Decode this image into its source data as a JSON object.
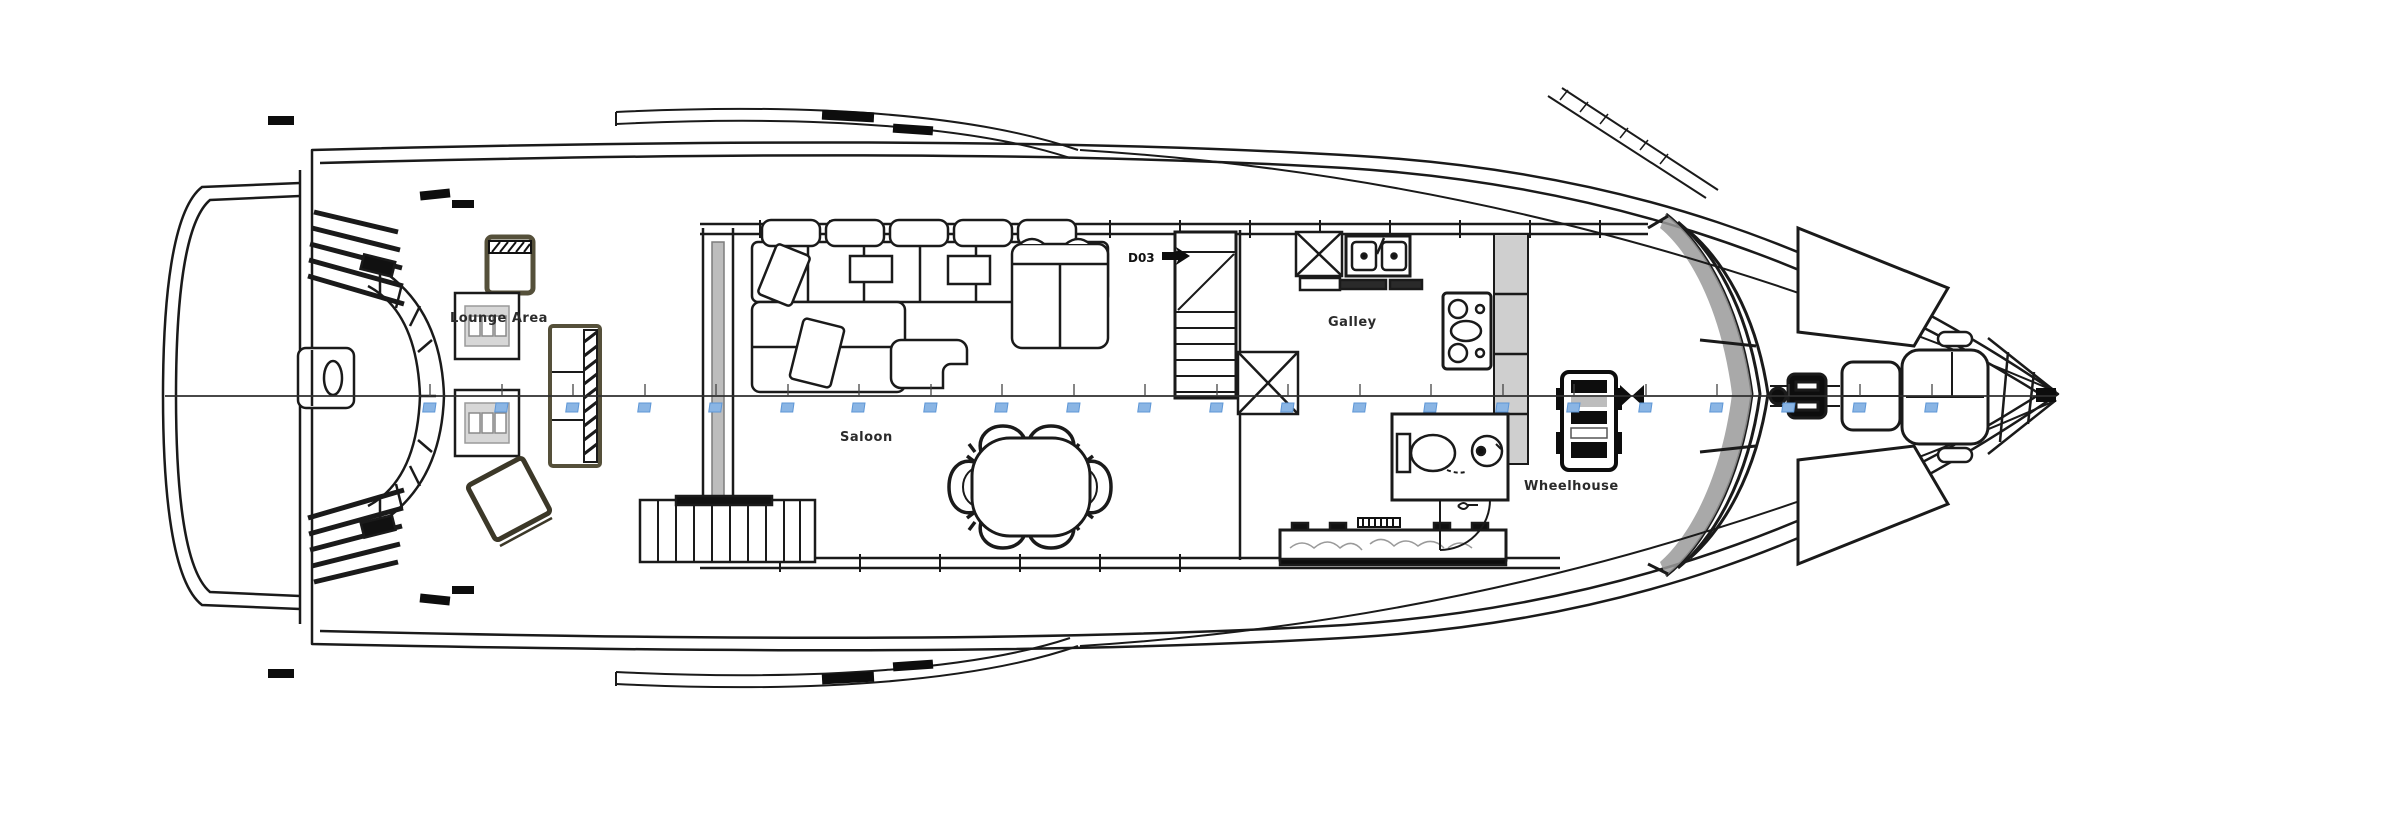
{
  "drawing": {
    "title": "Yacht main deck floor plan (top view, bow to the right)",
    "labels": {
      "lounge_area": "Lounge Area",
      "saloon": "Saloon",
      "galley": "Galley",
      "wheelhouse": "Wheelhouse",
      "stairs_code": "D03"
    },
    "colors": {
      "line": "#1a1a1a",
      "accent_olive": "#55503a",
      "panel_gray": "#c8c8c8",
      "marker_blue": "#8ab5e4",
      "marker_blue_edge": "#5d96d6"
    },
    "stations": {
      "y_line": 396,
      "x_positions": [
        430,
        502,
        573,
        645,
        716,
        788,
        859,
        931,
        1002,
        1074,
        1145,
        1217,
        1288,
        1360,
        1431,
        1503,
        1574,
        1646,
        1717,
        1789,
        1860,
        1932
      ]
    }
  }
}
